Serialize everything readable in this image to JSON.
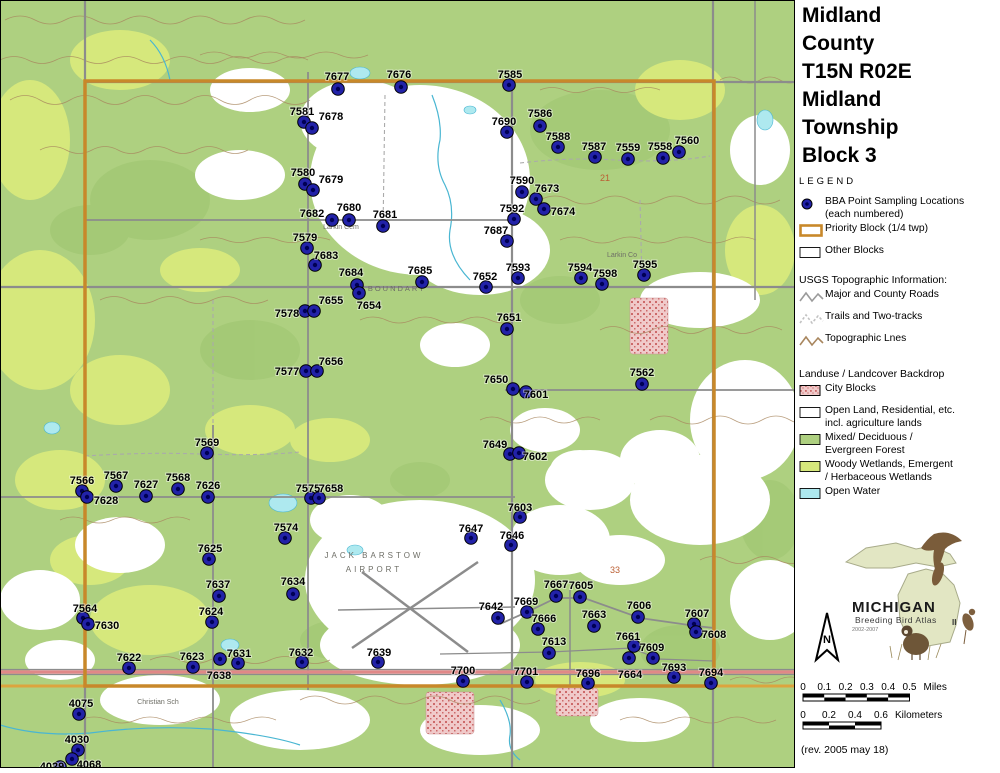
{
  "title_lines": [
    "Midland",
    "County",
    "T15N R02E",
    "Midland",
    "Township",
    "Block 3"
  ],
  "legend": {
    "heading": "LEGEND",
    "items": [
      {
        "icon": "dot",
        "lines": [
          "BBA Point Sampling Locations",
          "(each numbered)"
        ]
      },
      {
        "icon": "rect-orange",
        "lines": [
          "Priority Block (1/4 twp)"
        ]
      },
      {
        "icon": "rect-plain",
        "lines": [
          "Other Blocks"
        ]
      }
    ],
    "usgs_heading": "USGS Topographic Information:",
    "usgs_items": [
      {
        "icon": "zigzag-gray",
        "lines": [
          "Major and County Roads"
        ]
      },
      {
        "icon": "zigzag-light",
        "lines": [
          "Trails and Two-tracks"
        ]
      },
      {
        "icon": "zigzag-brown",
        "lines": [
          "Topographic Lnes"
        ]
      }
    ],
    "landuse_heading": "Landuse / Landcover Backdrop",
    "landuse_items": [
      {
        "icon": "swatch-pink",
        "lines": [
          "City Blocks"
        ]
      },
      {
        "icon": "swatch-white",
        "lines": [
          "Open Land, Residential, etc.",
          "incl. agriculture lands"
        ]
      },
      {
        "icon": "swatch-green",
        "lines": [
          "Mixed/ Deciduous /",
          "Evergreen Forest"
        ]
      },
      {
        "icon": "swatch-yellowgreen",
        "lines": [
          "Woody Wetlands, Emergent",
          "/ Herbaceous Wetlands"
        ]
      },
      {
        "icon": "swatch-cyan",
        "lines": [
          "Open Water"
        ]
      }
    ]
  },
  "logo": {
    "name": "MICHIGAN",
    "subtitle": "Breeding Bird Atlas",
    "years": "2002-2007",
    "numeral": "II"
  },
  "north_label": "N",
  "scalebars": {
    "miles": {
      "ticks": [
        "0",
        "0.1",
        "0.2",
        "0.3",
        "0.4",
        "0.5"
      ],
      "unit": "Miles"
    },
    "kilometers": {
      "ticks": [
        "0",
        "0.2",
        "0.4",
        "0.6"
      ],
      "unit": "Kilometers"
    }
  },
  "revision": "(rev. 2005 may 18)",
  "colors": {
    "point": "#2222a8",
    "point_core": "#000055",
    "priority": "#c8882a",
    "forest": "#aed080",
    "wetland": "#d6e87c",
    "water": "#aee9ef",
    "city": "#efc9c9",
    "city_dot": "#cc6a6a",
    "road": "#8c8c8c",
    "trail": "#bdbdbd",
    "topo": "#a8865e",
    "highway": "#e08888",
    "road_orange": "#dca43e"
  },
  "map": {
    "points": [
      {
        "n": "7677",
        "x": 338,
        "y": 89,
        "lx": 337,
        "ly": 76
      },
      {
        "n": "7676",
        "x": 401,
        "y": 87,
        "lx": 399,
        "ly": 74
      },
      {
        "n": "7585",
        "x": 509,
        "y": 85,
        "lx": 510,
        "ly": 74
      },
      {
        "n": "7581",
        "x": 304,
        "y": 122,
        "lx": 302,
        "ly": 111
      },
      {
        "n": "7678",
        "x": 312,
        "y": 128,
        "lx": 331,
        "ly": 116
      },
      {
        "n": "7690",
        "x": 507,
        "y": 132,
        "lx": 504,
        "ly": 121
      },
      {
        "n": "7586",
        "x": 540,
        "y": 126,
        "lx": 540,
        "ly": 113
      },
      {
        "n": "7588",
        "x": 558,
        "y": 147,
        "lx": 558,
        "ly": 136
      },
      {
        "n": "7587",
        "x": 595,
        "y": 157,
        "lx": 594,
        "ly": 146
      },
      {
        "n": "7559",
        "x": 628,
        "y": 159,
        "lx": 628,
        "ly": 147
      },
      {
        "n": "7558",
        "x": 663,
        "y": 158,
        "lx": 660,
        "ly": 146
      },
      {
        "n": "7560",
        "x": 679,
        "y": 152,
        "lx": 687,
        "ly": 140
      },
      {
        "n": "7580",
        "x": 305,
        "y": 184,
        "lx": 303,
        "ly": 172
      },
      {
        "n": "7679",
        "x": 313,
        "y": 190,
        "lx": 331,
        "ly": 179
      },
      {
        "n": "7590",
        "x": 522,
        "y": 192,
        "lx": 522,
        "ly": 180
      },
      {
        "n": "7673",
        "x": 536,
        "y": 199,
        "lx": 547,
        "ly": 188
      },
      {
        "n": "7674",
        "x": 544,
        "y": 209,
        "lx": 563,
        "ly": 211
      },
      {
        "n": "7592",
        "x": 514,
        "y": 219,
        "lx": 512,
        "ly": 208
      },
      {
        "n": "7682",
        "x": 332,
        "y": 220,
        "lx": 312,
        "ly": 213
      },
      {
        "n": "7680",
        "x": 349,
        "y": 220,
        "lx": 349,
        "ly": 207
      },
      {
        "n": "7681",
        "x": 383,
        "y": 226,
        "lx": 385,
        "ly": 214
      },
      {
        "n": "7687",
        "x": 507,
        "y": 241,
        "lx": 496,
        "ly": 230
      },
      {
        "n": "7579",
        "x": 307,
        "y": 248,
        "lx": 305,
        "ly": 237
      },
      {
        "n": "7683",
        "x": 315,
        "y": 265,
        "lx": 326,
        "ly": 255
      },
      {
        "n": "7684",
        "x": 357,
        "y": 285,
        "lx": 351,
        "ly": 272
      },
      {
        "n": "7654",
        "x": 359,
        "y": 293,
        "lx": 369,
        "ly": 305
      },
      {
        "n": "7685",
        "x": 422,
        "y": 282,
        "lx": 420,
        "ly": 270
      },
      {
        "n": "7652",
        "x": 486,
        "y": 287,
        "lx": 485,
        "ly": 276
      },
      {
        "n": "7593",
        "x": 518,
        "y": 278,
        "lx": 518,
        "ly": 267
      },
      {
        "n": "7594",
        "x": 581,
        "y": 278,
        "lx": 580,
        "ly": 267
      },
      {
        "n": "7598",
        "x": 602,
        "y": 284,
        "lx": 605,
        "ly": 273
      },
      {
        "n": "7595",
        "x": 644,
        "y": 275,
        "lx": 645,
        "ly": 264
      },
      {
        "n": "7578",
        "x": 305,
        "y": 311,
        "lx": 287,
        "ly": 313
      },
      {
        "n": "7655",
        "x": 314,
        "y": 311,
        "lx": 331,
        "ly": 300
      },
      {
        "n": "7651",
        "x": 507,
        "y": 329,
        "lx": 509,
        "ly": 317
      },
      {
        "n": "7577",
        "x": 306,
        "y": 371,
        "lx": 287,
        "ly": 371
      },
      {
        "n": "7656",
        "x": 317,
        "y": 371,
        "lx": 331,
        "ly": 361
      },
      {
        "n": "7650",
        "x": 513,
        "y": 389,
        "lx": 496,
        "ly": 379
      },
      {
        "n": "7601",
        "x": 526,
        "y": 392,
        "lx": 536,
        "ly": 394
      },
      {
        "n": "7562",
        "x": 642,
        "y": 384,
        "lx": 642,
        "ly": 372
      },
      {
        "n": "7569",
        "x": 207,
        "y": 453,
        "lx": 207,
        "ly": 442
      },
      {
        "n": "7566",
        "x": 82,
        "y": 491,
        "lx": 82,
        "ly": 480
      },
      {
        "n": "7567",
        "x": 116,
        "y": 486,
        "lx": 116,
        "ly": 475
      },
      {
        "n": "7627",
        "x": 146,
        "y": 496,
        "lx": 146,
        "ly": 484
      },
      {
        "n": "7568",
        "x": 178,
        "y": 489,
        "lx": 178,
        "ly": 477
      },
      {
        "n": "7626",
        "x": 208,
        "y": 497,
        "lx": 208,
        "ly": 485
      },
      {
        "n": "7628",
        "x": 87,
        "y": 497,
        "lx": 106,
        "ly": 500
      },
      {
        "n": "7575",
        "x": 311,
        "y": 498,
        "lx": 308,
        "ly": 488
      },
      {
        "n": "7658",
        "x": 319,
        "y": 498,
        "lx": 331,
        "ly": 488
      },
      {
        "n": "7574",
        "x": 285,
        "y": 538,
        "lx": 286,
        "ly": 527
      },
      {
        "n": "7625",
        "x": 209,
        "y": 559,
        "lx": 210,
        "ly": 548
      },
      {
        "n": "7637",
        "x": 219,
        "y": 596,
        "lx": 218,
        "ly": 584
      },
      {
        "n": "7634",
        "x": 293,
        "y": 594,
        "lx": 293,
        "ly": 581
      },
      {
        "n": "7624",
        "x": 212,
        "y": 622,
        "lx": 211,
        "ly": 611
      },
      {
        "n": "7564",
        "x": 83,
        "y": 618,
        "lx": 85,
        "ly": 608
      },
      {
        "n": "7630",
        "x": 88,
        "y": 624,
        "lx": 107,
        "ly": 625
      },
      {
        "n": "7622",
        "x": 129,
        "y": 668,
        "lx": 129,
        "ly": 657
      },
      {
        "n": "7623",
        "x": 193,
        "y": 667,
        "lx": 192,
        "ly": 656
      },
      {
        "n": "7638",
        "x": 220,
        "y": 659,
        "lx": 219,
        "ly": 675
      },
      {
        "n": "7631",
        "x": 238,
        "y": 663,
        "lx": 239,
        "ly": 653
      },
      {
        "n": "7632",
        "x": 302,
        "y": 662,
        "lx": 301,
        "ly": 652
      },
      {
        "n": "7639",
        "x": 378,
        "y": 662,
        "lx": 379,
        "ly": 652
      },
      {
        "n": "7700",
        "x": 463,
        "y": 681,
        "lx": 463,
        "ly": 670
      },
      {
        "n": "7701",
        "x": 527,
        "y": 682,
        "lx": 526,
        "ly": 671
      },
      {
        "n": "7696",
        "x": 588,
        "y": 683,
        "lx": 588,
        "ly": 673
      },
      {
        "n": "7642",
        "x": 498,
        "y": 618,
        "lx": 491,
        "ly": 606
      },
      {
        "n": "7669",
        "x": 527,
        "y": 612,
        "lx": 526,
        "ly": 601
      },
      {
        "n": "7666",
        "x": 538,
        "y": 629,
        "lx": 544,
        "ly": 618
      },
      {
        "n": "7613",
        "x": 549,
        "y": 653,
        "lx": 554,
        "ly": 641
      },
      {
        "n": "7667",
        "x": 556,
        "y": 596,
        "lx": 556,
        "ly": 584
      },
      {
        "n": "7605",
        "x": 580,
        "y": 597,
        "lx": 581,
        "ly": 585
      },
      {
        "n": "7663",
        "x": 594,
        "y": 626,
        "lx": 594,
        "ly": 614
      },
      {
        "n": "7606",
        "x": 638,
        "y": 617,
        "lx": 639,
        "ly": 605
      },
      {
        "n": "7661",
        "x": 634,
        "y": 646,
        "lx": 628,
        "ly": 636
      },
      {
        "n": "7609",
        "x": 653,
        "y": 658,
        "lx": 652,
        "ly": 647
      },
      {
        "n": "7664",
        "x": 629,
        "y": 658,
        "lx": 630,
        "ly": 674
      },
      {
        "n": "7693",
        "x": 674,
        "y": 677,
        "lx": 674,
        "ly": 667
      },
      {
        "n": "7694",
        "x": 711,
        "y": 683,
        "lx": 711,
        "ly": 672
      },
      {
        "n": "7607",
        "x": 694,
        "y": 624,
        "lx": 697,
        "ly": 613
      },
      {
        "n": "7608",
        "x": 696,
        "y": 632,
        "lx": 714,
        "ly": 634
      },
      {
        "n": "7649",
        "x": 510,
        "y": 454,
        "lx": 495,
        "ly": 444
      },
      {
        "n": "7602",
        "x": 519,
        "y": 453,
        "lx": 535,
        "ly": 456
      },
      {
        "n": "7603",
        "x": 520,
        "y": 517,
        "lx": 520,
        "ly": 507
      },
      {
        "n": "7646",
        "x": 511,
        "y": 545,
        "lx": 512,
        "ly": 535
      },
      {
        "n": "7647",
        "x": 471,
        "y": 538,
        "lx": 471,
        "ly": 528
      },
      {
        "n": "4075",
        "x": 79,
        "y": 714,
        "lx": 81,
        "ly": 703
      },
      {
        "n": "4030",
        "x": 78,
        "y": 750,
        "lx": 77,
        "ly": 739
      },
      {
        "n": "4068",
        "x": 72,
        "y": 759,
        "lx": 89,
        "ly": 764
      },
      {
        "n": "4029",
        "x": 60,
        "y": 767,
        "lx": 52,
        "ly": 766
      }
    ],
    "place_labels": [
      {
        "t": "Larkin Cem",
        "x": 341,
        "y": 229,
        "size": 7,
        "sp": 0
      },
      {
        "t": "BOUNDARY",
        "x": 397,
        "y": 291,
        "size": 7.5,
        "sp": 2
      },
      {
        "t": "JACK BARSTOW",
        "x": 374,
        "y": 558,
        "size": 8,
        "sp": 3
      },
      {
        "t": "AIRPORT",
        "x": 374,
        "y": 572,
        "size": 8,
        "sp": 3
      },
      {
        "t": "Christian Sch",
        "x": 158,
        "y": 704,
        "size": 7,
        "sp": 0
      },
      {
        "t": "Larkin Co",
        "x": 622,
        "y": 257,
        "size": 7,
        "sp": 0
      }
    ],
    "section_numbers": [
      {
        "t": "21",
        "x": 600,
        "y": 181
      },
      {
        "t": "33",
        "x": 610,
        "y": 573
      }
    ]
  }
}
